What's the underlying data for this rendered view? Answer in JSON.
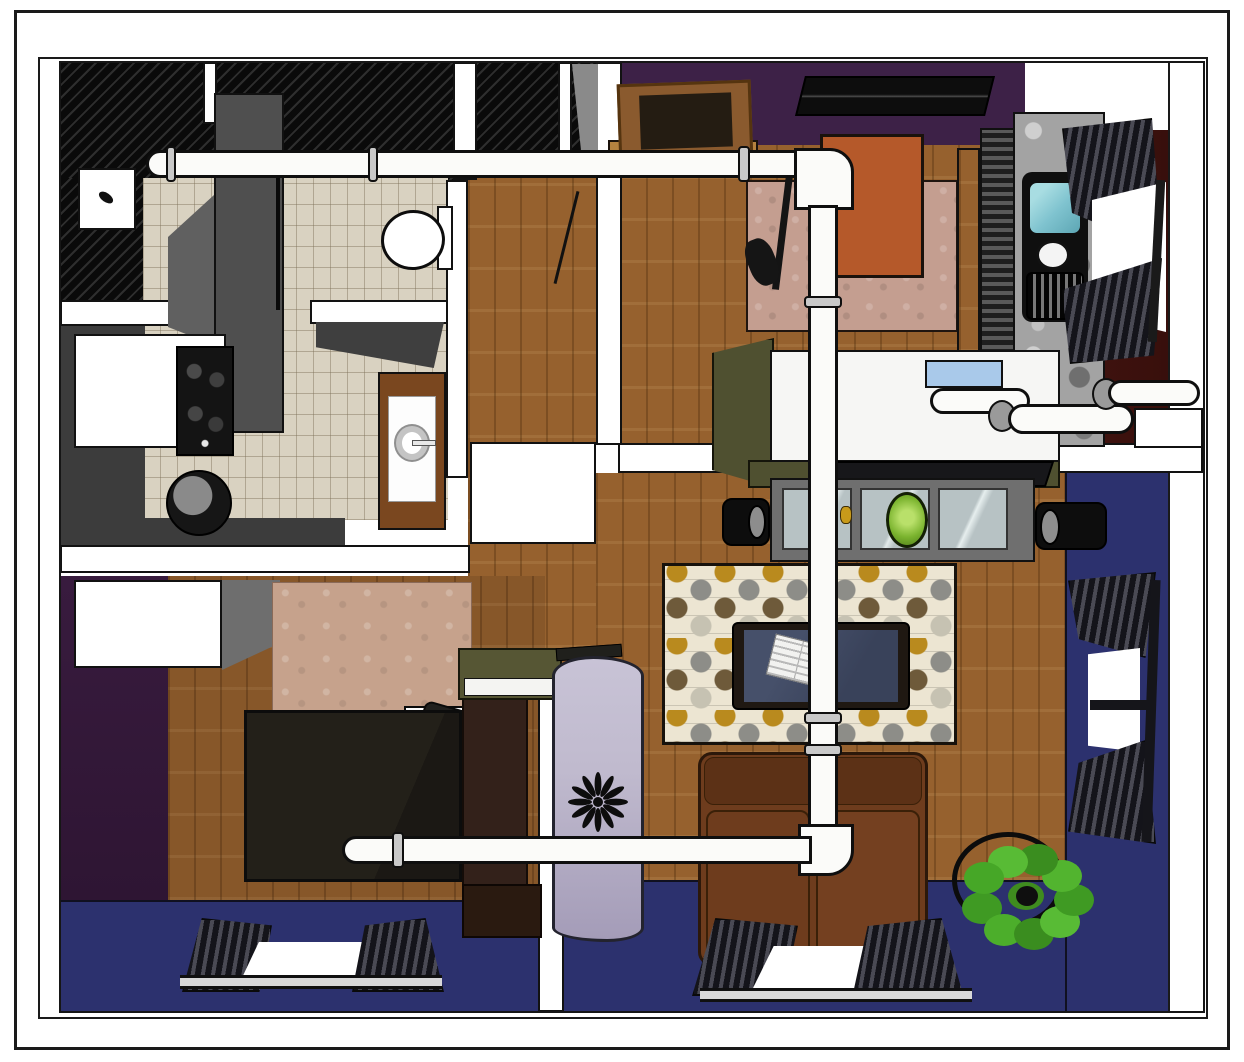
{
  "meta": {
    "kind": "3d-floor-plan-rendering",
    "description": "Top-down 3D rendering of a one-bedroom apartment with exposed white ductwork running through kitchen, entry, living room and bedroom"
  },
  "palette": {
    "frame": "#1a1a1a",
    "white": "#ffffff",
    "black": "#121212",
    "pipe": "#fbfbf9",
    "hatch_dark": "#0a0a0a",
    "hatch_light": "#2e2e2e",
    "tile": "#d9d2c1",
    "wood": "#96612e",
    "purple": "#3d2147",
    "purple_dark": "#381b3e",
    "maroon": "#451510",
    "blue": "#2c316e",
    "olive": "#4f5030",
    "granite": "#a3a3a3",
    "couch": "#6e3c1d",
    "rug_cream": "#ece5d2",
    "rug_gold": "#b98a1e",
    "rug_gray": "#8d8d88",
    "rug_brown": "#6e5a3a",
    "entry_rug": "#c49e90",
    "tan_rug": "#c6a28c",
    "aqua": "#7fc3cf",
    "green": "#46a727",
    "lavender": "#c0bace",
    "console": "#6f6f6f",
    "glass": "#b7c2c4",
    "orange": "#b5592a",
    "door_wood": "#8a5a2e",
    "duvet": "#232019",
    "headboard": "#33211a",
    "gray_cab": "#4f4f4f"
  },
  "rooms": [
    {
      "name": "kitchen",
      "items": [
        "ceiling-hatch",
        "ceiling-light",
        "tall-cabinet",
        "white-counter",
        "stove",
        "trash-can",
        "tile-floor"
      ]
    },
    {
      "name": "bathroom",
      "items": [
        "toilet",
        "wall-shelf",
        "sink-vanity",
        "tile-floor"
      ]
    },
    {
      "name": "entry",
      "items": [
        "entry-door",
        "ceiling-vent",
        "side-table",
        "entry-rug",
        "coat-stand"
      ]
    },
    {
      "name": "kitchen-sink-nook",
      "items": [
        "granite-counter",
        "sink-basin",
        "faucet",
        "dish-rack",
        "window-curtains"
      ]
    },
    {
      "name": "living-room",
      "items": [
        "desk",
        "media-console",
        "speakers",
        "patterned-rug",
        "coffee-table",
        "magazine",
        "sofa",
        "plant-stand",
        "wreath-plant",
        "windows"
      ]
    },
    {
      "name": "bedroom",
      "items": [
        "dresser",
        "area-rug",
        "bed",
        "pillows",
        "headboard",
        "nightstand",
        "room-divider-curtain",
        "window"
      ]
    }
  ],
  "ductwork": [
    "top-horizontal-duct",
    "vertical-duct",
    "lower-horizontal-duct",
    "elbow-joints",
    "couplings"
  ]
}
